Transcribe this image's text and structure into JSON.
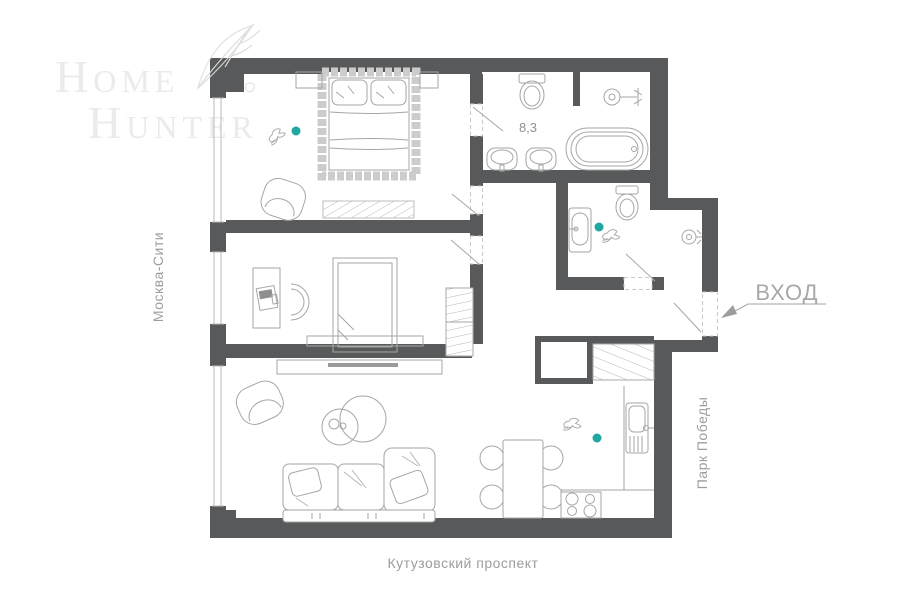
{
  "branding": {
    "logo_line1": "Home",
    "logo_line2": "Hunter"
  },
  "plan": {
    "room_area_label": "8,3",
    "entrance_label": "ВХОД"
  },
  "surroundings": {
    "west_label": "Москва-Сити",
    "east_label": "Парк Победы",
    "south_label": "Кутузовский проспект"
  },
  "decorations": {
    "feather": "feather-sketch",
    "birds": "hummingbird-sketch",
    "accent_dot_count": 3
  },
  "colors": {
    "wall": "#58595b",
    "furniture_stroke": "#a6a6a6",
    "label_text": "#9b9d9f",
    "accent": "#21a7a2",
    "logo": "#ebebeb"
  }
}
